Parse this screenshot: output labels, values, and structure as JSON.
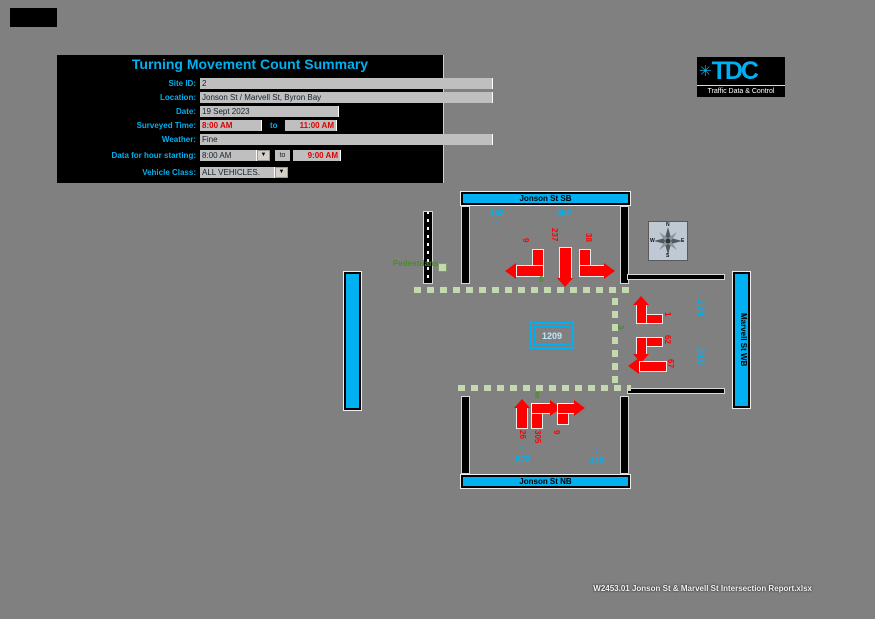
{
  "page": {
    "filename": "W2453.01 Jonson St & Marvell St Intersection Report.xlsx"
  },
  "icons": {
    "dropdown": "▼",
    "logo_junction": "✳"
  },
  "form": {
    "title": "Turning Movement Count Summary",
    "site_id": {
      "label": "Site ID:",
      "value": "2"
    },
    "location": {
      "label": "Location:",
      "value": "Jonson St / Marvell St, Byron Bay"
    },
    "date": {
      "label": "Date:",
      "value": "19 Sept 2023"
    },
    "surveyed_time": {
      "label": "Surveyed Time:",
      "from": "8:00 AM",
      "to_word": "to",
      "to": "11:00 AM"
    },
    "weather": {
      "label": "Weather:",
      "value": "Fine"
    },
    "hour_starting": {
      "label": "Data for hour starting:",
      "value": "8:00 AM",
      "to_word": "to",
      "end": "9:00 AM"
    },
    "vehicle_class": {
      "label": "Vehicle Class:",
      "value": "ALL VEHICLES."
    }
  },
  "logo": {
    "brand": "TDC",
    "tagline": "Traffic Data & Control"
  },
  "compass": {
    "n": "N",
    "e": "E",
    "s": "S",
    "w": "W"
  },
  "diagram": {
    "streets": {
      "north": "Jonson St SB",
      "south": "Jonson St NB",
      "east": "Marvell St WB"
    },
    "legend": {
      "pedestrians": "Pedestrians"
    },
    "total_entering": "1209",
    "volumes": {
      "north_out": {
        "value": "152",
        "arrow": "↑"
      },
      "north_in": {
        "value": "452",
        "arrow": "↓"
      },
      "south_in": {
        "value": "623",
        "arrow": "↑"
      },
      "south_out": {
        "value": "419",
        "arrow": "↓"
      },
      "east_in": {
        "value": "134",
        "arrow": "←"
      },
      "east_out": {
        "value": "310",
        "arrow": "→"
      }
    },
    "movements": {
      "sb_right": "9",
      "sb_through": "237",
      "sb_left": "38",
      "nb_through": "26",
      "nb_right": "305",
      "nb_left": "9",
      "wb_right": "1",
      "wb_left": "62",
      "wb_through": "67"
    },
    "pedestrians": {
      "north": "6",
      "south": "8",
      "east": "3"
    }
  }
}
